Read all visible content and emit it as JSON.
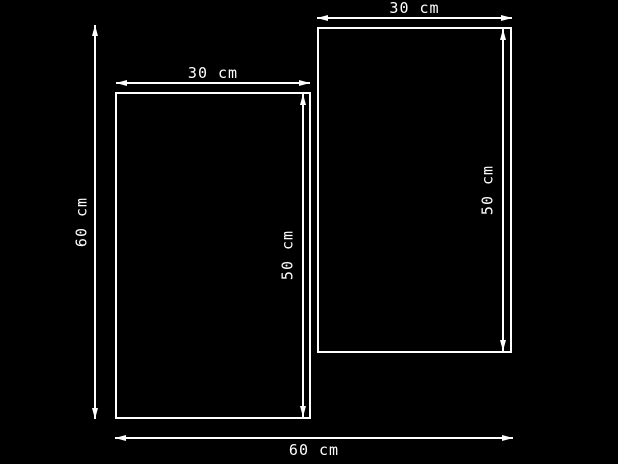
{
  "drawing": {
    "background_color": "#000000",
    "stroke_color": "#ffffff",
    "dimensions": {
      "left_panel_width": "30 cm",
      "right_panel_width": "30 cm",
      "overall_height": "60 cm",
      "left_panel_height": "50 cm",
      "right_panel_height": "50 cm",
      "overall_width": "60 cm"
    }
  }
}
